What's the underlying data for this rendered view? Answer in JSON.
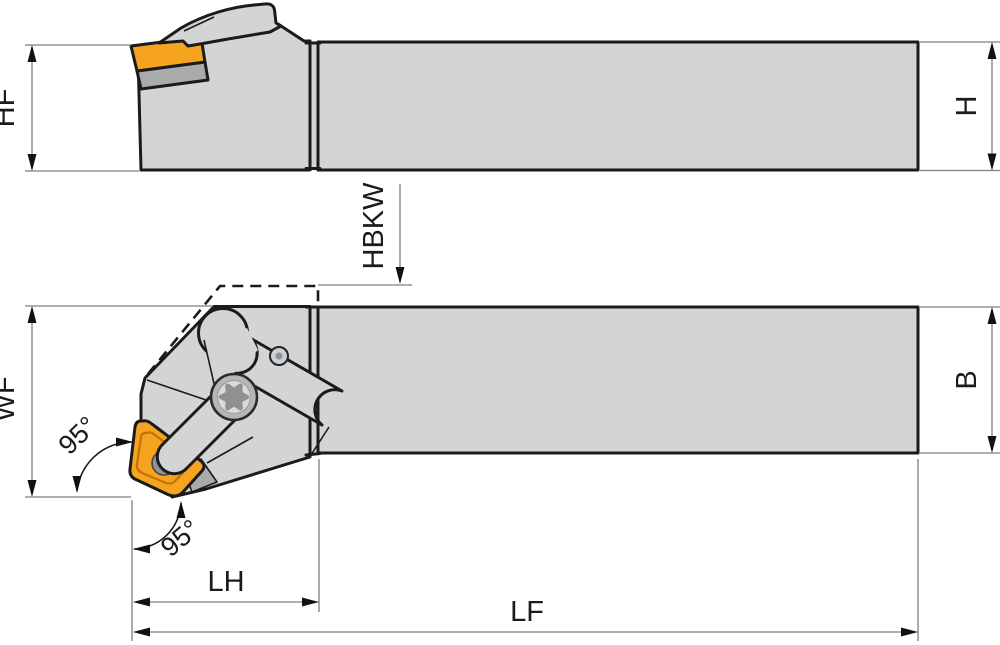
{
  "diagram": {
    "type": "technical-drawing",
    "subject": "lathe turning tool holder, two orthographic views",
    "views": {
      "side_view": {
        "labels": {
          "hf": "HF",
          "h": "H",
          "hbkw": "HBKW"
        }
      },
      "plan_view": {
        "labels": {
          "wf": "WF",
          "b": "B",
          "lh": "LH",
          "lf": "LF",
          "angle_side": "95°",
          "angle_bottom": "95°"
        }
      }
    },
    "colors": {
      "body": "#d3d4d6",
      "insert": "#f6a41f",
      "insert_groove": "#c07400",
      "shim": "#a9abad",
      "hole": "#909294",
      "screw_ring": "#b4b6b8",
      "screw_inner": "#dadbdd",
      "screw_star": "#8e9092",
      "small_screw": "#cdd0d2",
      "outline": "#1b1b1b",
      "dim_line": "#7d7d7d"
    }
  }
}
